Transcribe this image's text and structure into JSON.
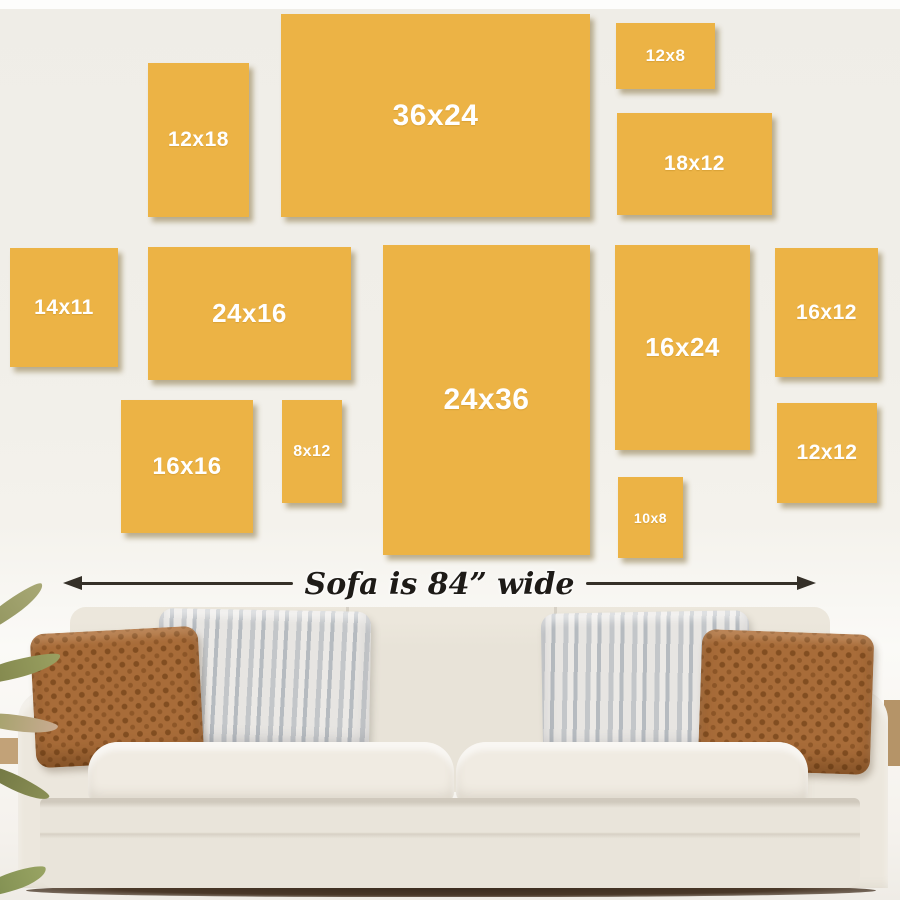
{
  "caption": {
    "text": "Sofa is 84” wide"
  },
  "colors": {
    "frame_fill": "#ecb345",
    "frame_label_text": "#ffffff",
    "arrow": "#353028",
    "wall": "#f1efe9",
    "sofa_fabric": "#eae5da",
    "pillow_rust": "#a86c39",
    "pillow_stripe_gray": "#c3c6c9",
    "plant_green": "#82874e",
    "floor_wood": "#c2a278"
  },
  "frames": [
    {
      "label": "12x18",
      "x": 148,
      "y": 63,
      "w": 101,
      "h": 154,
      "fs": 21
    },
    {
      "label": "36x24",
      "x": 281,
      "y": 14,
      "w": 309,
      "h": 203,
      "fs": 30
    },
    {
      "label": "12x8",
      "x": 616,
      "y": 23,
      "w": 99,
      "h": 66,
      "fs": 17
    },
    {
      "label": "18x12",
      "x": 617,
      "y": 113,
      "w": 155,
      "h": 102,
      "fs": 21
    },
    {
      "label": "14x11",
      "x": 10,
      "y": 248,
      "w": 108,
      "h": 119,
      "fs": 21
    },
    {
      "label": "24x16",
      "x": 148,
      "y": 247,
      "w": 203,
      "h": 133,
      "fs": 26
    },
    {
      "label": "24x36",
      "x": 383,
      "y": 245,
      "w": 207,
      "h": 310,
      "fs": 30
    },
    {
      "label": "16x24",
      "x": 615,
      "y": 245,
      "w": 135,
      "h": 205,
      "fs": 26
    },
    {
      "label": "16x12",
      "x": 775,
      "y": 248,
      "w": 103,
      "h": 129,
      "fs": 21
    },
    {
      "label": "16x16",
      "x": 121,
      "y": 400,
      "w": 132,
      "h": 133,
      "fs": 24
    },
    {
      "label": "8x12",
      "x": 282,
      "y": 400,
      "w": 60,
      "h": 103,
      "fs": 16
    },
    {
      "label": "10x8",
      "x": 618,
      "y": 477,
      "w": 65,
      "h": 81,
      "fs": 14
    },
    {
      "label": "12x12",
      "x": 777,
      "y": 403,
      "w": 100,
      "h": 100,
      "fs": 21
    }
  ]
}
